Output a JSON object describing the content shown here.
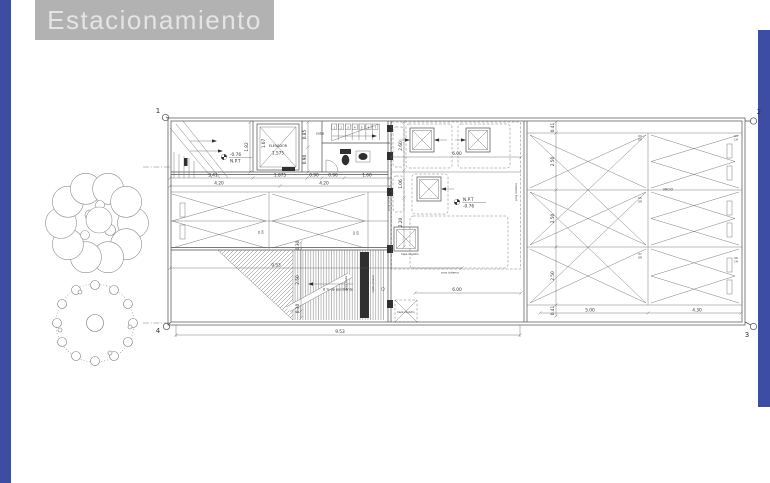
{
  "page": {
    "background": "#ffffff",
    "accent_blue": "#3c4da3",
    "titlebox_gray": "#b2b2b2",
    "line_color": "#4f4f4f"
  },
  "title_block": {
    "text": "Estacionamiento"
  },
  "plan": {
    "axis": {
      "m1": "1",
      "m2": "2",
      "m3": "3",
      "m4": "4"
    },
    "elevator": {
      "name": "ELEVADOR",
      "size": "1.575"
    },
    "stairs": {
      "up": "sube",
      "steps": [
        "1",
        "2",
        "3",
        "4",
        "5",
        "6",
        "7"
      ]
    },
    "npt_entry": {
      "value": "-0.76",
      "label": "N.P.T"
    },
    "npt_court": {
      "label": "N.P.T",
      "value": "-0.76"
    },
    "notes": {
      "tapa_registro": "tapa registro",
      "tapa_registro_2": "tapa registro",
      "proy_cisterna_bottom": "proy cisterna",
      "proy_cisterna_right": "proy cisterna",
      "proy_cisterna_left": "proy cisterna",
      "vacio": "VACIO",
      "pendiente": "8 % de pendiente",
      "rejilla": "rejilla pluvial",
      "trabe": "proy. trabe"
    },
    "dims": {
      "d341": "3.41",
      "d1875": "1.875",
      "d090a": "0.90",
      "d090b": "0.90",
      "d160": "1.60",
      "d420a": "4.20",
      "d420b": "4.20",
      "d182": "1.82",
      "d107": "1.07",
      "d085": "0.85",
      "d090c": "0.90",
      "d260": "2.60",
      "d106": "1.06",
      "d220": "2.20",
      "d600a": "6.00",
      "d600b": "6.00",
      "d041a": "0.41",
      "d250a": "2.50",
      "d250b": "2.50",
      "d250c": "2.50",
      "d041b": "0.41",
      "d030a": "0.30",
      "d250r": "2.50",
      "d030b": "0.30",
      "d953a": "9.53",
      "d953b": "9.53",
      "d500": "5.00",
      "d430": "4.30"
    },
    "stalls": [
      {
        "num": "01",
        "type": "GR"
      },
      {
        "num": "02",
        "type": "GR"
      },
      {
        "num": "03",
        "type": "GR"
      },
      {
        "num": "05",
        "type": "GR"
      },
      {
        "num": "07",
        "type": "GR"
      },
      {
        "num": "04",
        "type": "CH"
      },
      {
        "num": "06",
        "type": "CH"
      }
    ]
  }
}
